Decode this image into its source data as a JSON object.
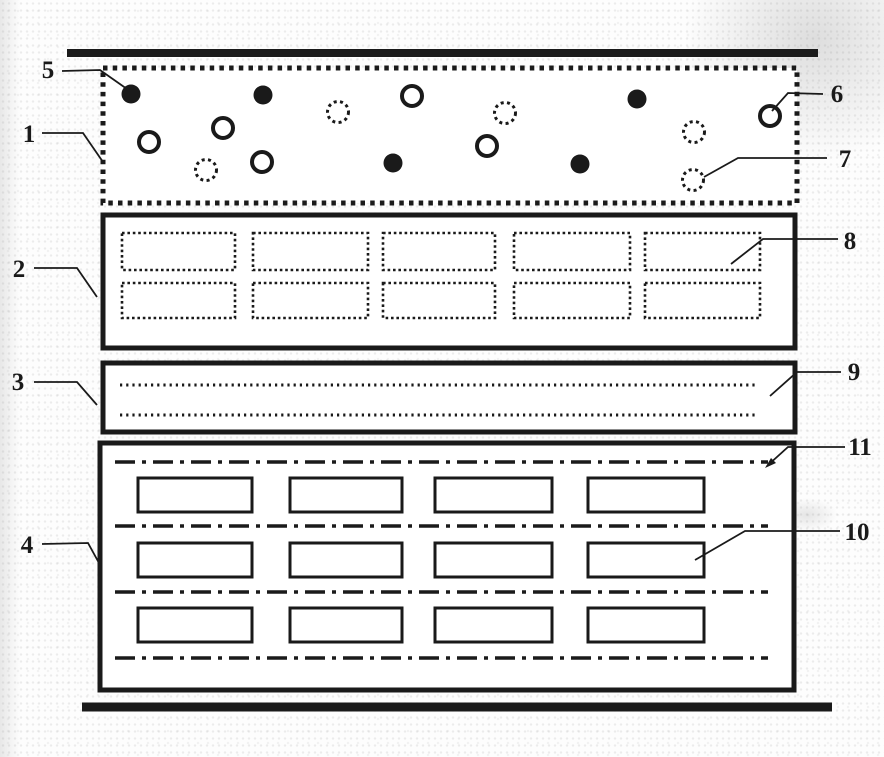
{
  "figure": {
    "colors": {
      "ink": "#1a1a1a",
      "paper": "#fdfdfd",
      "fill": "#ffffff"
    },
    "top_rule": {
      "x1": 67,
      "x2": 818,
      "y": 53,
      "stroke_width": 8
    },
    "bottom_rule": {
      "x1": 82,
      "x2": 832,
      "y": 707,
      "stroke_width": 9
    },
    "layers": [
      {
        "ref": "1",
        "style": "dotted",
        "x": 103,
        "y": 68,
        "w": 694,
        "h": 135
      },
      {
        "ref": "2",
        "style": "solid",
        "x": 103,
        "y": 215,
        "w": 692,
        "h": 133
      },
      {
        "ref": "3",
        "style": "solid",
        "x": 103,
        "y": 363,
        "w": 692,
        "h": 69
      },
      {
        "ref": "4",
        "style": "solid",
        "x": 100,
        "y": 443,
        "w": 694,
        "h": 247
      }
    ],
    "particles": {
      "filled": [
        [
          131,
          94
        ],
        [
          263,
          95
        ],
        [
          637,
          99
        ],
        [
          393,
          163
        ],
        [
          580,
          164
        ]
      ],
      "open": [
        [
          149,
          142
        ],
        [
          223,
          128
        ],
        [
          412,
          96
        ],
        [
          262,
          162
        ],
        [
          487,
          146
        ],
        [
          770,
          116
        ]
      ],
      "dotted": [
        [
          338,
          112
        ],
        [
          505,
          113
        ],
        [
          206,
          170
        ],
        [
          694,
          132
        ],
        [
          693,
          180
        ]
      ]
    },
    "dotted_slots": {
      "rows": [
        {
          "y": 233,
          "h": 37
        },
        {
          "y": 283,
          "h": 35
        }
      ],
      "cols": [
        {
          "x": 122,
          "w": 113
        },
        {
          "x": 253,
          "w": 115
        },
        {
          "x": 383,
          "w": 112
        },
        {
          "x": 514,
          "w": 116
        },
        {
          "x": 645,
          "w": 115
        }
      ]
    },
    "dotted_channel_lines": {
      "x1": 120,
      "x2": 758,
      "ys": [
        385,
        415
      ]
    },
    "dashdot_lines": {
      "x1": 115,
      "x2": 768,
      "ys": [
        462,
        526,
        592,
        658
      ]
    },
    "solid_slots": {
      "rows": [
        {
          "y": 478,
          "h": 34
        },
        {
          "y": 543,
          "h": 34
        },
        {
          "y": 608,
          "h": 34
        }
      ],
      "cols": [
        {
          "x": 138,
          "w": 114
        },
        {
          "x": 290,
          "w": 112
        },
        {
          "x": 435,
          "w": 117
        },
        {
          "x": 588,
          "w": 116
        }
      ]
    },
    "labels": [
      {
        "text": "1",
        "x": 29,
        "y": 142,
        "leader": [
          [
            42,
            133
          ],
          [
            83,
            133
          ],
          [
            103,
            162
          ]
        ]
      },
      {
        "text": "2",
        "x": 19,
        "y": 277,
        "leader": [
          [
            34,
            268
          ],
          [
            77,
            268
          ],
          [
            97,
            297
          ]
        ]
      },
      {
        "text": "3",
        "x": 18,
        "y": 390,
        "leader": [
          [
            34,
            382
          ],
          [
            77,
            382
          ],
          [
            97,
            405
          ]
        ]
      },
      {
        "text": "4",
        "x": 27,
        "y": 553,
        "leader": [
          [
            42,
            544
          ],
          [
            88,
            543
          ],
          [
            99,
            563
          ]
        ]
      },
      {
        "text": "5",
        "x": 48,
        "y": 78,
        "leader": [
          [
            62,
            71
          ],
          [
            100,
            70
          ],
          [
            127,
            89
          ]
        ]
      },
      {
        "text": "6",
        "x": 837,
        "y": 102,
        "leader": [
          [
            823,
            94
          ],
          [
            788,
            93
          ],
          [
            772,
            111
          ]
        ]
      },
      {
        "text": "7",
        "x": 845,
        "y": 167,
        "leader": [
          [
            827,
            158
          ],
          [
            738,
            158
          ],
          [
            704,
            177
          ]
        ]
      },
      {
        "text": "8",
        "x": 850,
        "y": 249,
        "leader": [
          [
            838,
            239
          ],
          [
            763,
            239
          ],
          [
            731,
            264
          ]
        ]
      },
      {
        "text": "9",
        "x": 854,
        "y": 380,
        "leader": [
          [
            841,
            372
          ],
          [
            797,
            372
          ],
          [
            770,
            396
          ]
        ]
      },
      {
        "text": "10",
        "x": 857,
        "y": 540,
        "leader": [
          [
            840,
            531
          ],
          [
            745,
            531
          ],
          [
            695,
            560
          ]
        ]
      },
      {
        "text": "11",
        "x": 860,
        "y": 455,
        "leader": [
          [
            845,
            447
          ],
          [
            788,
            447
          ],
          [
            767,
            466
          ]
        ],
        "arrow": [
          [
            765,
            468
          ],
          [
            771,
            458
          ],
          [
            776,
            463
          ]
        ]
      }
    ]
  }
}
